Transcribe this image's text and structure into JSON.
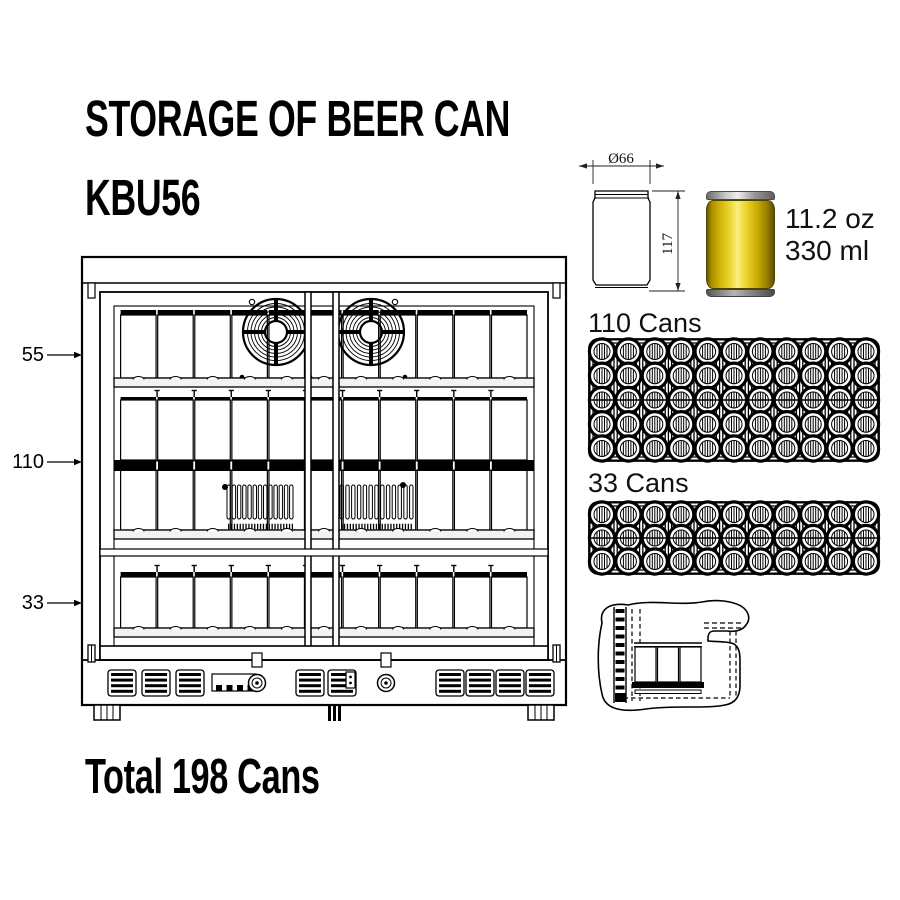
{
  "header": {
    "title": "STORAGE OF BEER CAN",
    "model": "KBU56"
  },
  "fridge": {
    "shelf_labels": [
      "55",
      "110",
      "33"
    ]
  },
  "can_spec": {
    "diameter": "Ø66",
    "height": "117",
    "volume_oz": "11.2 oz",
    "volume_ml": "330 ml",
    "body_color": "#e3c30a"
  },
  "trays": [
    {
      "label": "110 Cans",
      "columns": 11,
      "rows": 5
    },
    {
      "label": "33 Cans",
      "columns": 11,
      "rows": 3
    }
  ],
  "total": "Total 198 Cans"
}
